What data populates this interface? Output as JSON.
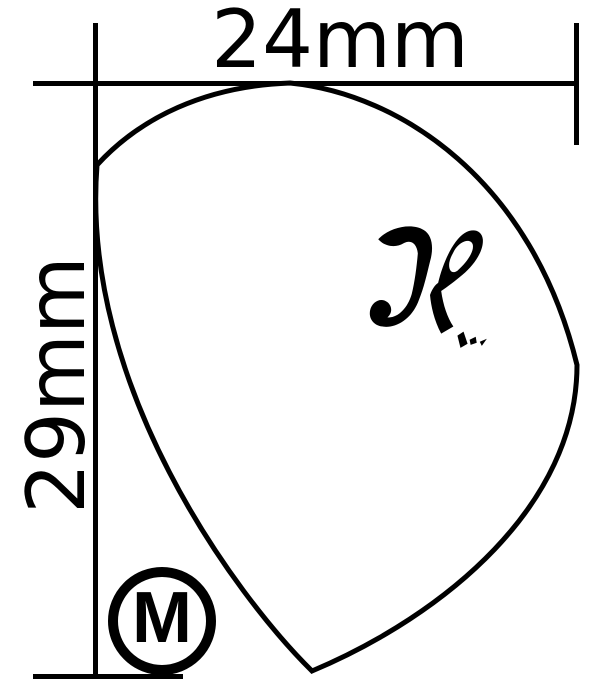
{
  "dimensions": {
    "width_label": "24mm",
    "height_label": "29mm"
  },
  "badge": {
    "gauge_label": "M"
  },
  "logo": {
    "letter": "H"
  },
  "colors": {
    "ink": "#000000",
    "background": "#ffffff"
  }
}
